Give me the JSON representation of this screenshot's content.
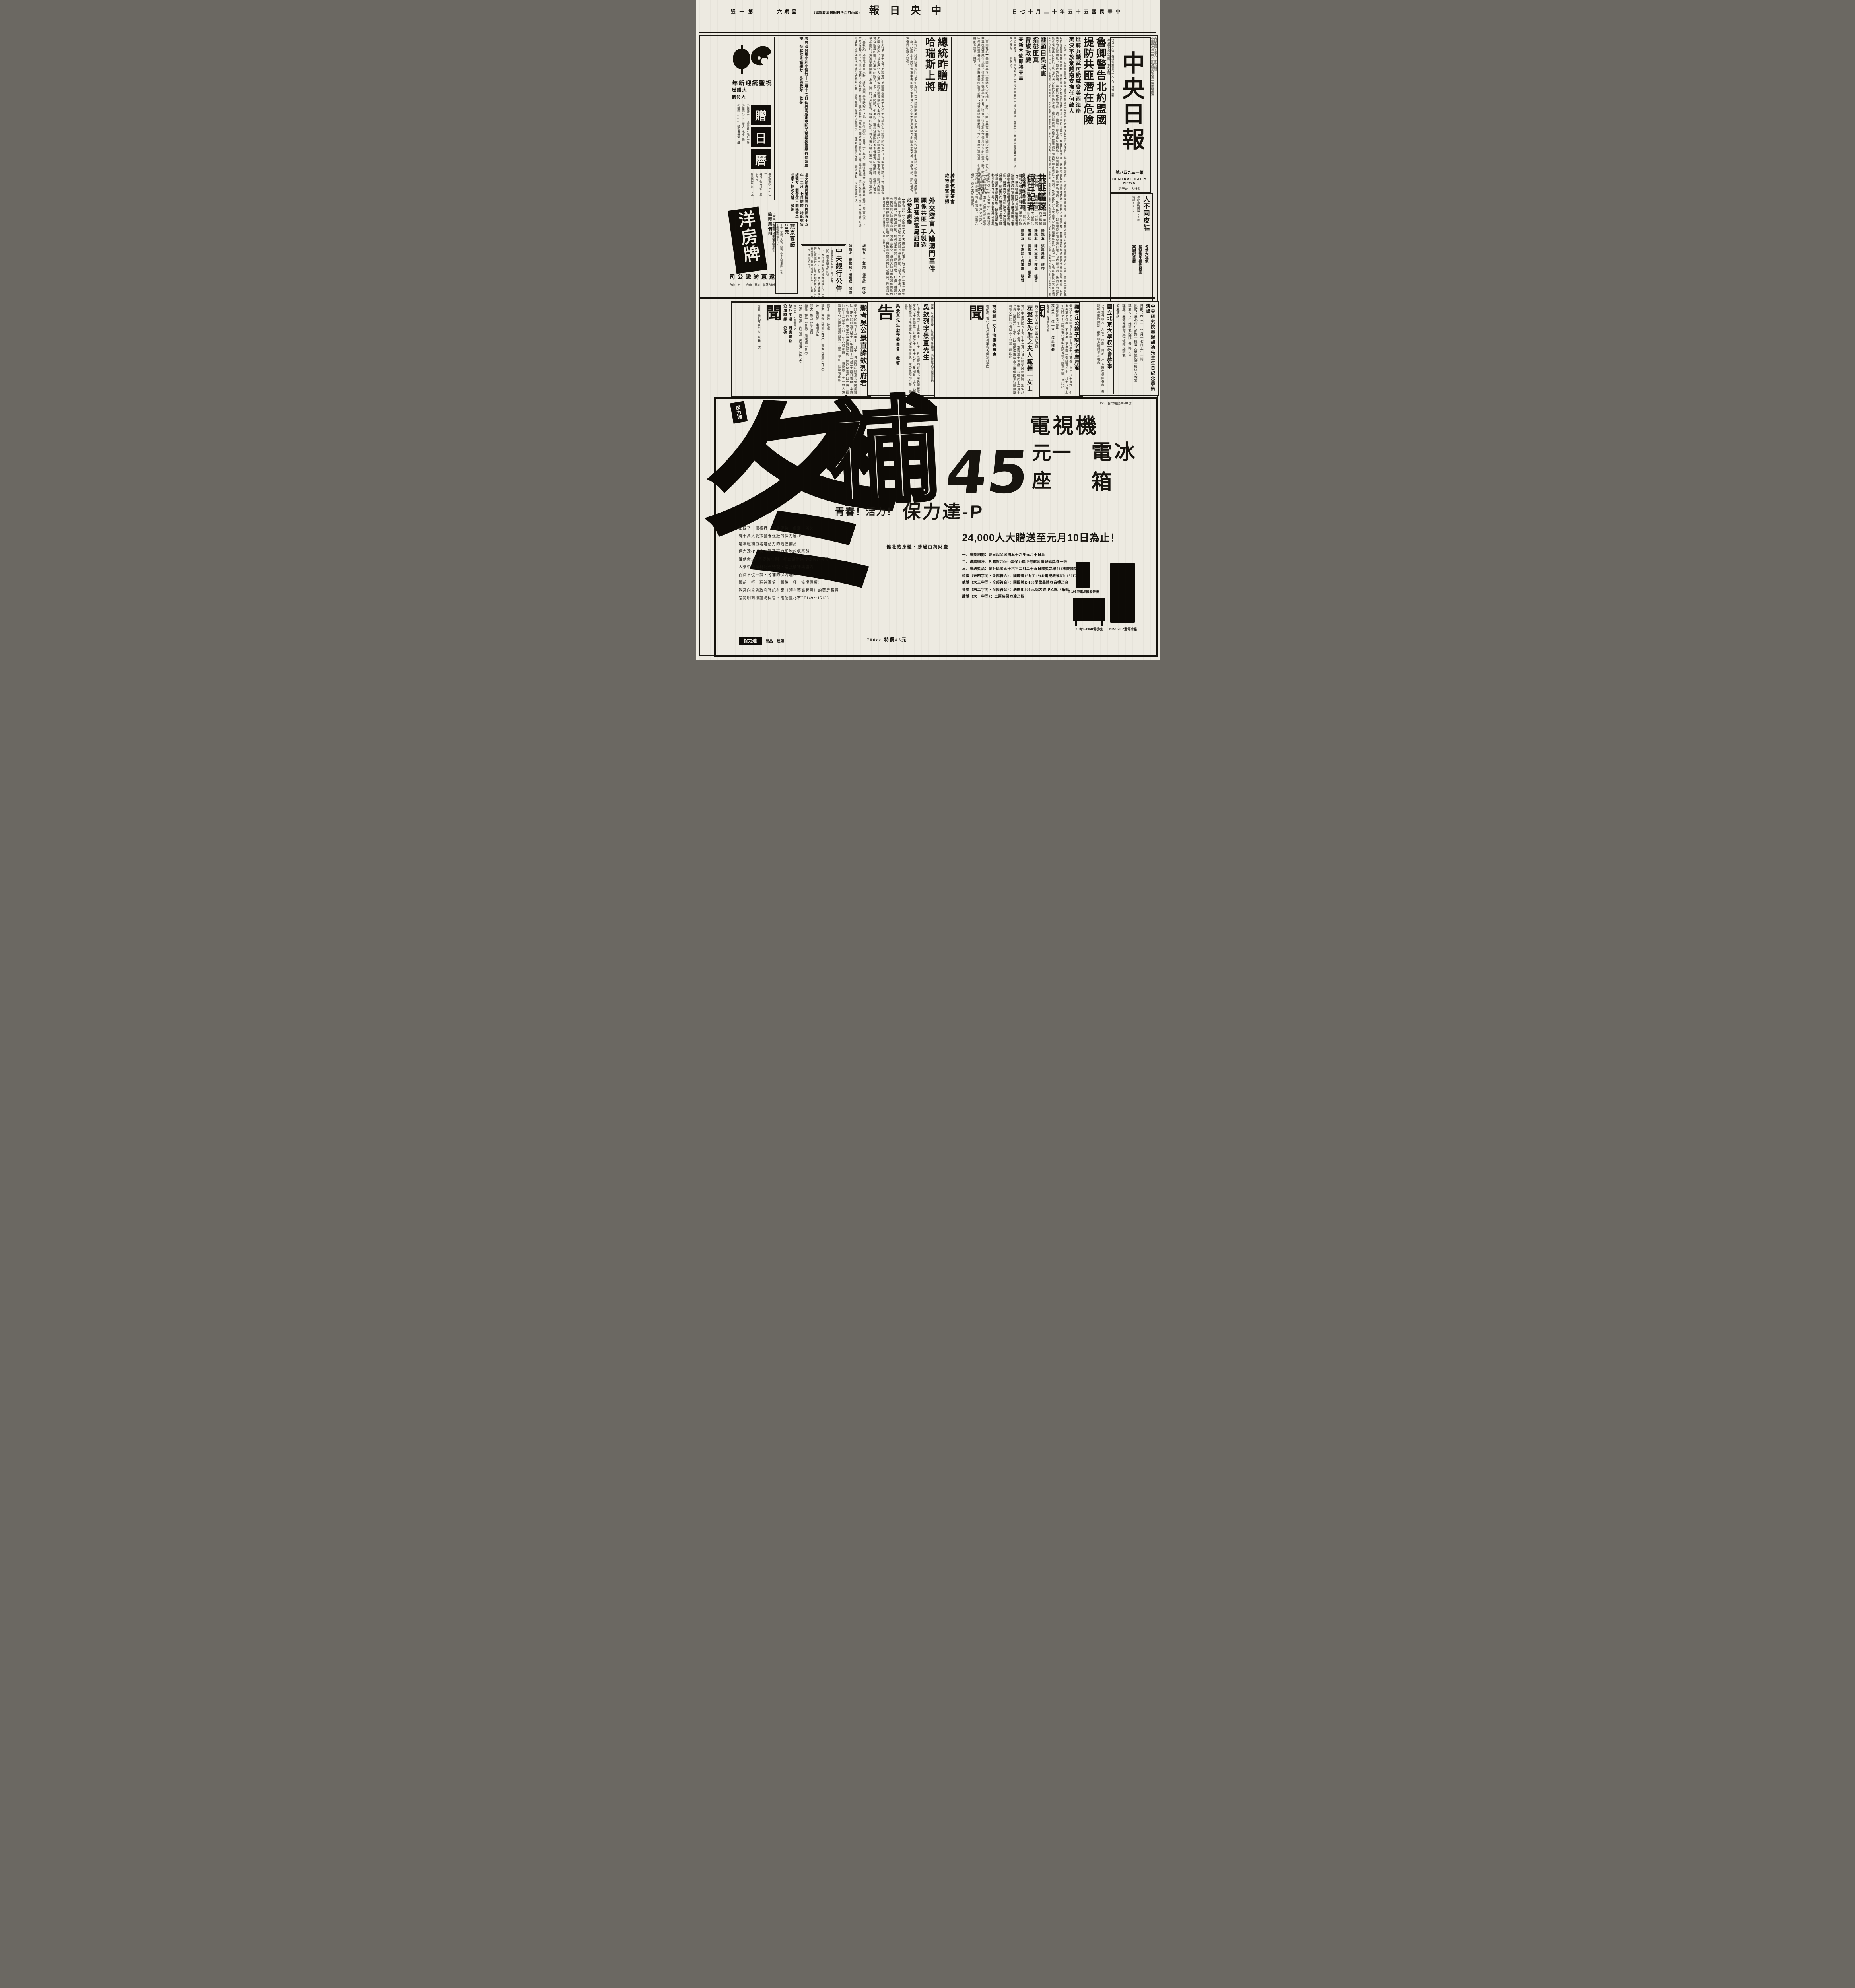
{
  "page": {
    "section_label": "第一張",
    "weekday": "星期六",
    "subscriber_note": "（國內訂戶今日附送星期雜誌）",
    "paper_title": "中央日報",
    "date_line": "中華民國五十五年十二月十七日"
  },
  "masthead": {
    "title": "中央日報",
    "issue_no": "第一三九四八號",
    "english_name": "CENTRAL DAILY NEWS",
    "publisher_line": "發行人　曹聖芬",
    "price_info": "今日二大張　每份售新臺幣一元二角　港幣二毫",
    "address": "地址臺北市中正路一七九五號",
    "registration1": "中華郵政第一四八號執照登記為第一類新聞紙類",
    "registration2": "內版臺誌字第九三號登記證"
  },
  "stories": {
    "lead": {
      "headline1": "魯卿警告北約盟國",
      "headline2": "提防共匪潛在危險",
      "subhead1": "匪窮兵黷武可能威脅美西海岸",
      "subhead2": "美決不放棄越南安撫任何敵人",
      "body": "【中央社巴黎十五日美聯電】美國國務卿魯斯克今天告訴大西洋聯盟的伙伴們，共匪窮兵黷武，可能威脅美國西海岸。據出席北大西洋公約組織會議的人士說，魯斯克告訴北約組織部長級理事會稱，關於美國對付有組織的匪共大單位的能力，現在已無問題，他承認在投到游擊隊的地下機構方面有困難。魯斯克曾列舉希臘的共黨游擊隊叛亂、馬來西亞的共黨動亂、韓戰的初期，與古巴危機的第一週。他說，與這些危機相比，越南戰爭是容易處理的問題。魯斯克說，越南的盟軍面對來自北方的不斷滲透，他們必須戰是憂慮或是進行對抗；然而已決心對抗共黨的滲透。雖仍繼續努力想將越南戰爭問題帶到會議桌上談判。魯斯克是於北大西洋公約組織理事會於此間——可能是最後一次在法國舉行的會議——舉行的為期兩天會議的第一天會議將近結束時，發表上項談話。談話約卅五分鐘，據報導曾獲得其他國家部長「良好接受」。魯斯克強調美國不會由於越南，而放棄對北大西洋公約組織所作的承諾。他曾為美國參加越南戰爭進行辯護，並稱美國不能一方面尊重北大西洋公約組織的公約，而另一方面不履行東南亞公約組織的公約。"
    },
    "peng": {
      "headline_lines": [
        "匪頭目吳法憲",
        "指彭匪真",
        "曾謀政變"
      ],
      "sidehead": "委新大使即將來華",
      "body": "匪偽廣播稱，彭匪真在所謂「文化大革命」中被指曾謀「政變」；共匪內部清算鬥爭，現已互相殘殺，日趨激烈。"
    },
    "expel": {
      "headline1": "共匪驅逐",
      "headline2": "俄三記者",
      "subhead": "說他們造謠誹謗",
      "body": "【中央社臺北十六日電】中共匪幫今日限令三個蘇俄記者於本月廿五日以前離境。據共匪新聞廣播，匪偽「外交部新聞司」今天召見蘇俄駐北平「代辦」，以此項決定告知。被驅逐的俄記者，係「塔斯社」駐北平記者等三人；共匪廣播指責他們對匪偽「文化大革命」的報導係「造謠誹謗」，並利用新聞採訪的便利蒐集情報，攻擊「毛澤東思想」，又舉說他們「歪曲事實、惡意中傷」，係不友好的舉動。"
    },
    "harris": {
      "headline1": "總統昨贈勳",
      "headline2": "哈瑞斯上將",
      "body_right": "【軍聞社訊】美國太平洋空軍總司令哈瑞斯上將，已結束其在中華民國的訪問日程，定於十七日上午十時乘專機離華飛往琉球，行前將在機場舉行記者招待會。這位將在下個月退休的空軍上將，昨天上午曾飛赴中部某空軍基地，視察駐臺美國空軍部隊；接受蔣總統贈勳後，下午曾應美軍第三二七航空師師長舉茲准將的邀請參加晚宴。",
      "body_left": "【本報訊】蔣總統曾於昨日下午五時，在官邸贈勳美國太平洋空軍總司令哈瑞斯上將，頒贈大綬雲麾勳章一座。哈瑞斯上將對促進中美兩國之軍事合作及保衛太平洋地區自由國家之安全，貢獻良多，勳功甚偉，深得我朝野之欽佩。"
    },
    "tea": {
      "line1": "總統伉儷茶會",
      "line2": "款待貴賓夫婦"
    },
    "macau": {
      "headline": "外交發言人論澳門事件",
      "subhead1": "顯係共匪一手製造",
      "subhead2": "圖迫葡澳當局屈服",
      "sidehead": "必發生劇變",
      "body": "【本報訊】外交部發言人昨天論及澳門事件時指出：此一事件顯係由共匪一手製造，圖迫葡澳當局對其暴亂屈服。發言人指出，大陸混亂已極，已無法控制，終必發生劇變。匪偽刊物「紅旗」雜誌已公開招認大陸遍地殺戮、流血及衝突，係由大陸日前所派的煽動份子與當地極端份子暴亂引起；與匪黨頑固派的挑起衝突，已達到嚴重的階段，最後決裂，大陸危機四伏。"
    }
  },
  "notices": {
    "left": [
      "次男海與馬小利小姐於十二月十七日在美國威州克利夫蘭城教堂舉行結婚典禮　特此敬告諸親友　吳陳愛芳　敬啓",
      "長女莉惠與董慶君於民國五十五年十二月十七日結婚　特此敬告諸親友　劉發煊・劉張喬森　林成章・林沈文蘭　敬啓"
    ],
    "mid": [
      "諸親友　張馬景武　謹啓",
      "諸親友　陳林宜慧・陳健　謹啓",
      "諸親友　張禹湘・馮瑩　謹啓",
      "諸親友　于高翔・偶雷琪　敬啓"
    ],
    "bank_side": "諸親友　鄭盛杞・張理房　謹啓"
  },
  "bank_notice": {
    "title": "中央銀行公告",
    "doc_no": "（55）臺央業字第1560號",
    "date": "中華民國五十五年十二月十五日",
    "item1": "一、本行經與財政部會商決定，自本年十二月十五日起，本行委託臺灣銀行在其總分支行所在地代售之政府公債種類，增加民國五十六年度第二期政府公債一種。",
    "item2": "二、特此公告。"
  },
  "left_ads": {
    "santa": {
      "title": "祝聖誕迎新年",
      "promo_label": "大贈送",
      "special_label": "大特價",
      "gifts": [
        "①購滿三○○元贈實用小毛巾一條",
        "②購滿八○○元贈大方毛巾一條",
        "③購滿一○○○元贈毛巾禮盒一組"
      ],
      "specials": [
        "男厚絨襯衫　二九七元",
        "男格子呢兩用衫　三五九元",
        "男長袖衛生衫　五九七元",
        "女長袖棉毛衫　七九五元"
      ],
      "calendar_chars": [
        "贈",
        "日",
        "曆"
      ]
    },
    "yangfang": {
      "brand": "洋房牌",
      "note1": "上西門町誠順道參觀",
      "note2": "臨時廉價部",
      "company": "遠東紡織公司",
      "branches": "台北・台中・台南・高雄・花蓮各地門市部"
    },
    "yanjing": {
      "title": "燕京舊語",
      "price": "20元",
      "sellers": "正中、文源、文化、幼獅、中央文物供應社有售",
      "mail": "直接郵購特價十六元",
      "account": "郵撥七一三六號栗明德帳戶"
    },
    "shoes": {
      "name": "大不同皮鞋",
      "address": "臺北市衡陽路94號",
      "phone": "電話6579"
    },
    "winter": {
      "lines": [
        "冬季大減價",
        "聖誕新年禮物最宜",
        "案頭紀事曆"
      ]
    }
  },
  "obituaries": {
    "jiang": {
      "big_char": "聞",
      "header": "顯考江公諱子誠字紫塵府君",
      "body": "慟於中華民國五十五年十月三十日棄養　享年八十有六　不孝男萬平侍疾　不孝男一平供職在臺謹擇於十二月十八日上午九時至十二時假臺北市中正路善導寺設奠追祭　哀此訃",
      "note": "閤族均陷不陸不列載",
      "mourner": "孤哀子　江一平　泣血稽顙",
      "contact": "聯絡處：立法院交際科"
    },
    "zuo": {
      "big_char": "聞",
      "header_small": "省立中興大學法商學院院長",
      "header": "左潞生先生之夫人臧鍾一女士",
      "body": "慟於中華民國五十五年十二月八日病逝榮民總醫院　距生於中華民國三年七月十三日　享壽五十三歲　茲擇於十二月十七日（星期六）上午八時在民權東路市立殯儀館景行廳設奠　引發安葬於六張犁市立公墓　謹此訃",
      "committee": "故臧鍾一女士治喪委員會",
      "contact": "聯絡處：臺北市合江街省立中興大學法商學院"
    },
    "wu_gao": {
      "big_char": "告",
      "titles": "前兵工生產署署長　行政院經合會顧問　高雄硫酸錏公司董事長",
      "header": "吳欽烈字景直先生",
      "body": "於中華民國五十五年十二月十二日辰時病逝臺北榮民總醫院　享年七十有四歲　茲擇於十二月十八日（星期日）上午九時起假臺北市民權東路市立殯儀館設奠　家祭後隨即公祭　特此訃",
      "committee": "吳景直先生治喪委員會　敬啓"
    },
    "wu_wen": {
      "big_char": "聞",
      "header": "顯考吳公景直諱欽烈府君",
      "body": "慟於中華民國五十五年十二月十二日辰時病逝臺北榮民總醫院　距生於前清光緒十九年農曆十二月二十四日吉時　享壽七十有四歲　不孝男鑄遠隨侍在側　鍊遠聞電趕回奔喪　謹訂於十二月十八日上午八時家祭　九時設奠　十一時大殮　隨即發引安葬於陽明山第一公墓　叩在　世誼哀此訃",
      "family_rows": [
        "孤子　鑄遠　鍊遠",
        "孤女　南強（適許・在美）　東安（適周・在美）",
        "媳　張奧英　李順茂華",
        "孫女　毅華（均在美）",
        "學孫　許平（在美）　周鼎澔（在美）",
        "外孫　許嘉浩　許嘉鴻　周道淇（均在美）",
        "未亡人　吳夏承玖"
      ],
      "note": "恕訃不週　鼎惠懇辭",
      "mourner": "泣血稽顙　泣啓",
      "address": "喪居：臺北市泉州街十八巷二號"
    }
  },
  "academy": {
    "title1": "中央研究院舉辦胡適先生生日紀念學術演講",
    "lines": [
      "日期：本（十二）月十七日上午十時",
      "地點：臺北市仁愛路一段臺大醫學院二樓綜合教室",
      "講演人：中央研究院院士葉曙先生",
      "講題：臺灣鼻咽癌流行地區之研究",
      "歡迎聽講"
    ],
    "title2": "國立北京大學校友會啓事",
    "body2": "本日為母校六十八週年校慶　訂於下午五時在僑園餐敘　恭請師長蒞臨致訓　歡迎校友踴躍參加餐敘"
  },
  "big_ad": {
    "tax_no": "（55）台財稅證09991號",
    "brand_logo": "保力達",
    "big_char": "冬",
    "outline_char": "補",
    "product_line1": "電視機",
    "price_number": "45",
    "price_suffix": "元一座",
    "product_line2": "電冰箱",
    "slogan_prefix": "青春！活力！",
    "slogan_brand": "保力達-P",
    "slogan_sub": "健壯的身體・勝過百萬財產",
    "promo_headline": "24,000人大贈送至元月10日為止！",
    "copy_lines": [
      "忙碌了一個禮拜・全身疲勞・虛弱・倦怠",
      "有十萬人愛飲營養強壯的保力達-P",
      "是年輕補血增進活力的最佳補品",
      "保力達-P・含有製造精力細胞的氨基酸",
      "維他命B群基礎強壯劑・補血幫助恢復疲勞的養分",
      "人參中西藥材配合特製・增強精神與體力",
      "百病不侵一試・冬補的保力達-P",
      "飯前一杯・精神百倍・飯後一杯・恢復疲勞！",
      "歡迎向全省政府登記有案（領有藥商牌照）的藥房購買",
      "請認明商標謹防假冒・電話臺北市FE149～15138"
    ],
    "prize_rows": [
      "一、贈獎期間：即日起至民國五十六年元月十日止",
      "二、贈獎辦法：凡購買700cc.裝保力達-P每瓶附送號碼獎券一張",
      "三、贈送獎品：統計民國五十六年二月二十五日開獎之第458期愛國獎券第一特獎號碼",
      "頭獎（末四字同・全部符合）：國際牌19吋T-196D電視機或NR-150FZ（白雪）電冰箱任選乙台",
      "貳獎（末三字同・全部符合）：國際牌R-105型電晶體收音機乙台",
      "參獎（末二字同・全部符合）：送贈用500cc.保力達-P乙瓶（箱裝）",
      "肆獎（末一字同）：二兩裝保力達乙瓶"
    ],
    "caption_radio": "R-105型電晶體收音機",
    "caption_tv": "19吋T-196D電視機",
    "caption_fridge": "NR-150FZ型電冰箱",
    "bottom_note": "700cc.特價45元",
    "bottom_brand": "保力達",
    "bottom_label1": "出品",
    "bottom_label2": "經銷"
  }
}
